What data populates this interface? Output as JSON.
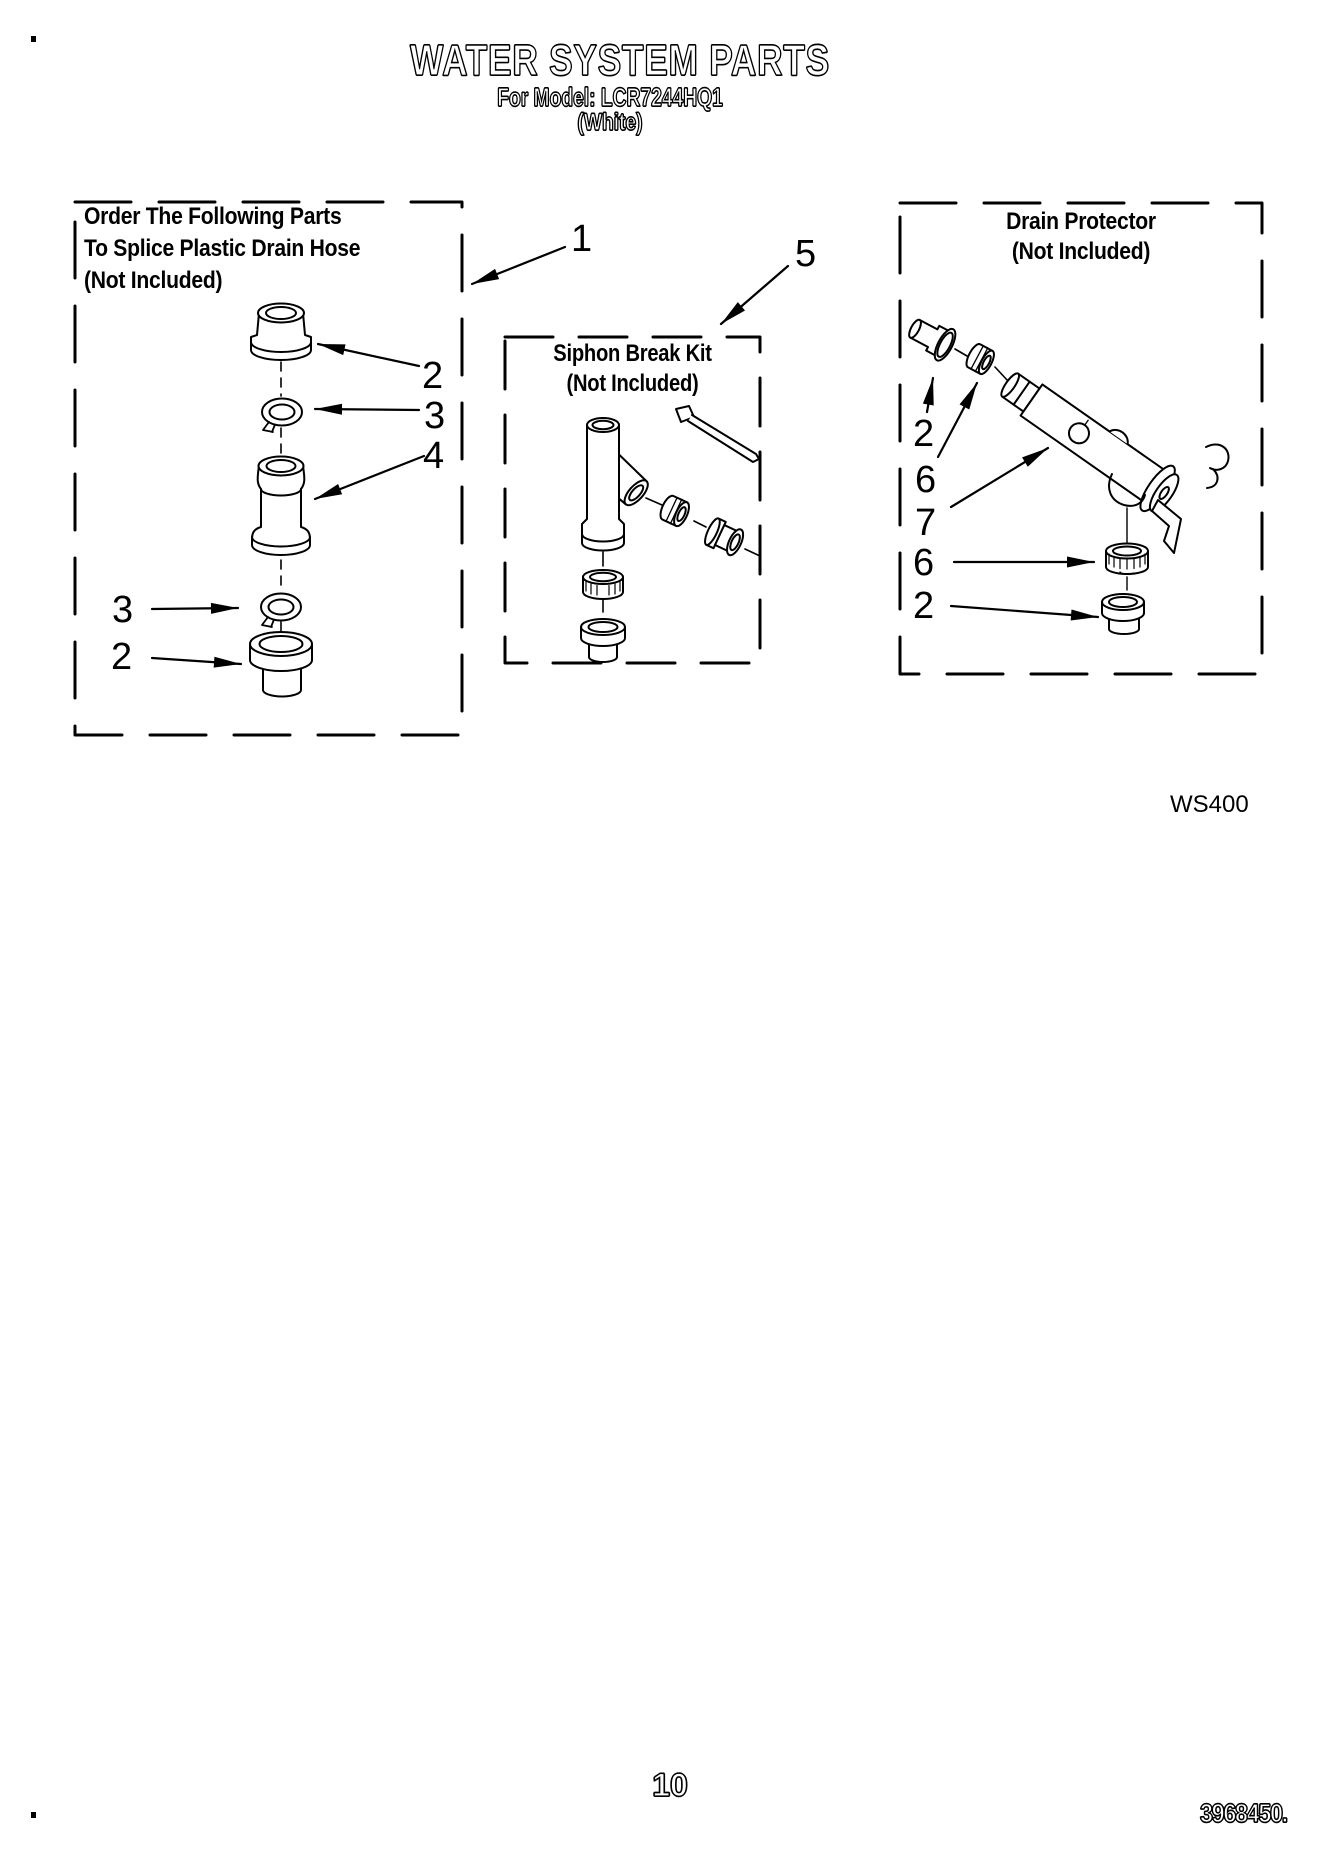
{
  "header": {
    "title": "WATER SYSTEM PARTS",
    "model_line": "For Model: LCR7244HQ1",
    "color_line": "(White)"
  },
  "boxes": {
    "splice": {
      "title": [
        "Order The Following Parts",
        "To Splice Plastic Drain Hose",
        "(Not Included)"
      ]
    },
    "siphon": {
      "title": [
        "Siphon Break Kit",
        "(Not Included)"
      ]
    },
    "drain": {
      "title": [
        "Drain Protector",
        "(Not Included)"
      ]
    }
  },
  "callouts": {
    "c1": "1",
    "c5": "5",
    "splice_2_top": "2",
    "splice_3_top": "3",
    "splice_4": "4",
    "splice_3_bottom": "3",
    "splice_2_bottom": "2",
    "drain_2_top": "2",
    "drain_6_top": "6",
    "drain_7": "7",
    "drain_6_bottom": "6",
    "drain_2_bottom": "2"
  },
  "footer": {
    "diagram_code": "WS400",
    "page_number": "10",
    "document_number": "3968450."
  }
}
